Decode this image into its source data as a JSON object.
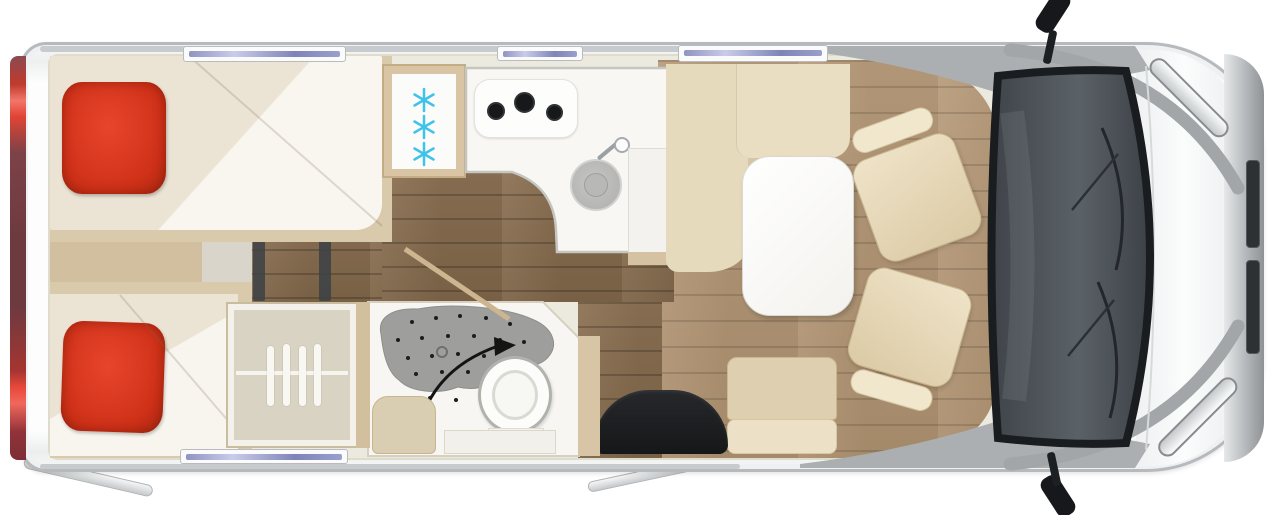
{
  "scene": {
    "title": "Motorhome floor plan — top view",
    "type": "floorplan",
    "view": "top-down"
  },
  "areas": {
    "rear": "twin single beds with red pillows",
    "mid_top": "kitchen with fridge, 3-burner hob and round sink",
    "mid_bottom": "wardrobe with hangers, bathroom with swivel shower wall and toilet, entry door with step mat",
    "front": "dinette with L-sofa, table, two swivelled cab seats, driver cab with windshield"
  },
  "fixtures": {
    "beds": 2,
    "pillows": 2,
    "fridge_snowflakes": 3,
    "hob_burners": 3,
    "sink": 1,
    "wardrobe_hangers": 4,
    "toilet": 1,
    "shower": 1,
    "swivel_arrow": 1,
    "dinette_table": 1,
    "swivel_seats": 2,
    "entry_mat": 1,
    "windows_top": 3,
    "windows_bottom": 1,
    "mirrors": 2,
    "headlights": 2,
    "awning_arms": 2,
    "tail_light_strip": 1
  },
  "colors": {
    "pillow_red": "#d23419",
    "tail_light_red": "#e8483a",
    "snowflake_blue": "#3fc3e8",
    "upholstery_beige": "#e6dabc",
    "wood_dark": "#8a6f52",
    "wood_light": "#b59a79",
    "shower_gray": "#9e9e9c",
    "windshield_gray": "#4a5056",
    "body_white": "#fdfdfd",
    "window_glass": "#8f94c2"
  }
}
